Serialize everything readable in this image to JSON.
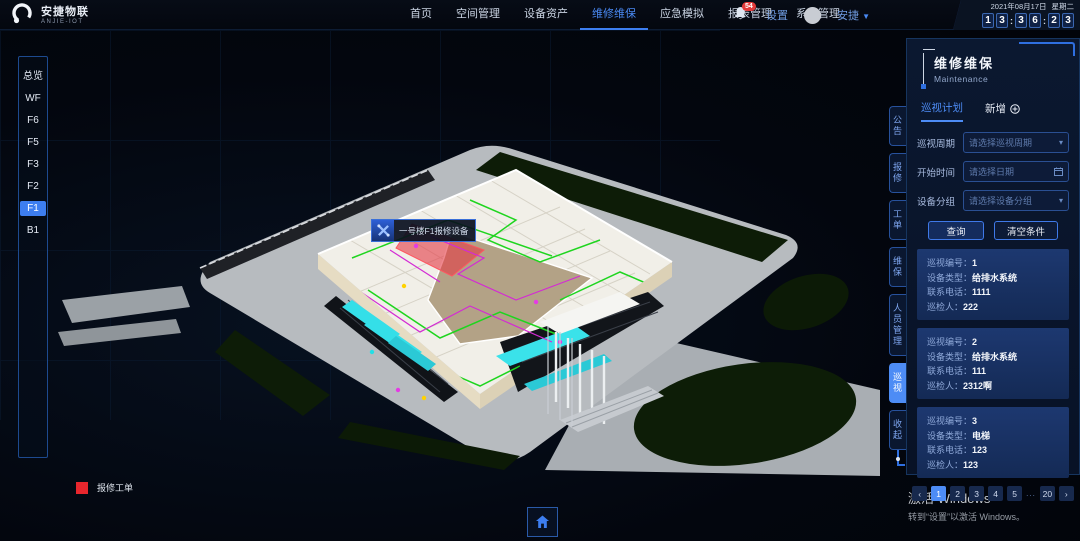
{
  "brand": {
    "name": "安捷物联",
    "sub": "ANJIE-IOT"
  },
  "navbar": {
    "items": [
      {
        "label": "首页",
        "active": false
      },
      {
        "label": "空间管理",
        "active": false
      },
      {
        "label": "设备资产",
        "active": false
      },
      {
        "label": "维修维保",
        "active": true
      },
      {
        "label": "应急模拟",
        "active": false
      },
      {
        "label": "报表管理",
        "active": false
      },
      {
        "label": "系统管理",
        "active": false
      }
    ],
    "bell_badge": "54",
    "settings": "设置",
    "user": "安捷",
    "caret": "▼",
    "date": "2021年08月17日",
    "weekday": "星期二",
    "time": {
      "d1": "1",
      "d2": "3",
      "d3": "3",
      "d4": "6",
      "d5": "2",
      "d6": "3",
      "colon": ":"
    }
  },
  "floors": {
    "items": [
      {
        "label": "总览",
        "active": false
      },
      {
        "label": "WF",
        "active": false
      },
      {
        "label": "F6",
        "active": false
      },
      {
        "label": "F5",
        "active": false
      },
      {
        "label": "F3",
        "active": false
      },
      {
        "label": "F2",
        "active": false
      },
      {
        "label": "F1",
        "active": true
      },
      {
        "label": "B1",
        "active": false
      }
    ]
  },
  "scene": {
    "tooltip": {
      "label": "一号楼F1报修设备"
    },
    "legend": {
      "label": "报修工单",
      "color": "#e8262d"
    }
  },
  "side_tabs": {
    "items": [
      {
        "label": "公告",
        "active": false
      },
      {
        "label": "报修",
        "active": false
      },
      {
        "label": "工单",
        "active": false
      },
      {
        "label": "维保",
        "active": false
      },
      {
        "label": "人员管理",
        "active": false
      },
      {
        "label": "巡视",
        "active": true
      },
      {
        "label": "收起",
        "active": false
      }
    ]
  },
  "panel": {
    "title": "维修维保",
    "subtitle": "Maintenance",
    "tab_plan": "巡视计划",
    "tab_new": "新增",
    "form": {
      "rows": [
        {
          "label": "巡视周期",
          "placeholder": "请选择巡视周期"
        },
        {
          "label": "开始时间",
          "placeholder": "请选择日期"
        },
        {
          "label": "设备分组",
          "placeholder": "请选择设备分组"
        }
      ],
      "query": "查询",
      "clear": "清空条件",
      "chevron": "▾"
    },
    "cards": [
      {
        "f1l": "巡视编号：",
        "f1v": "1",
        "f2l": "设备类型：",
        "f2v": "给排水系统",
        "f3l": "联系电话：",
        "f3v": "1111",
        "f4l": "巡检人：",
        "f4v": "222"
      },
      {
        "f1l": "巡视编号：",
        "f1v": "2",
        "f2l": "设备类型：",
        "f2v": "给排水系统",
        "f3l": "联系电话：",
        "f3v": "111",
        "f4l": "巡检人：",
        "f4v": "2312啊"
      },
      {
        "f1l": "巡视编号：",
        "f1v": "3",
        "f2l": "设备类型：",
        "f2v": "电梯",
        "f3l": "联系电话：",
        "f3v": "123",
        "f4l": "巡检人：",
        "f4v": "123"
      }
    ],
    "pagination": {
      "prev": "‹",
      "next": "›",
      "p1": "1",
      "p2": "2",
      "p3": "3",
      "p4": "4",
      "p5": "5",
      "ellipsis": "...",
      "last": "20"
    }
  },
  "windows": {
    "line1": "激活 Windows",
    "line2": "转到“设置”以激活 Windows。"
  },
  "colors": {
    "accent": "#4d8cf5",
    "panel_border": "#27519c",
    "card_bg": "#1d3870",
    "danger": "#e8262d",
    "pipe_green": "#1fd51f",
    "pipe_magenta": "#d42ad4",
    "glass_cyan": "#34dfe8"
  }
}
